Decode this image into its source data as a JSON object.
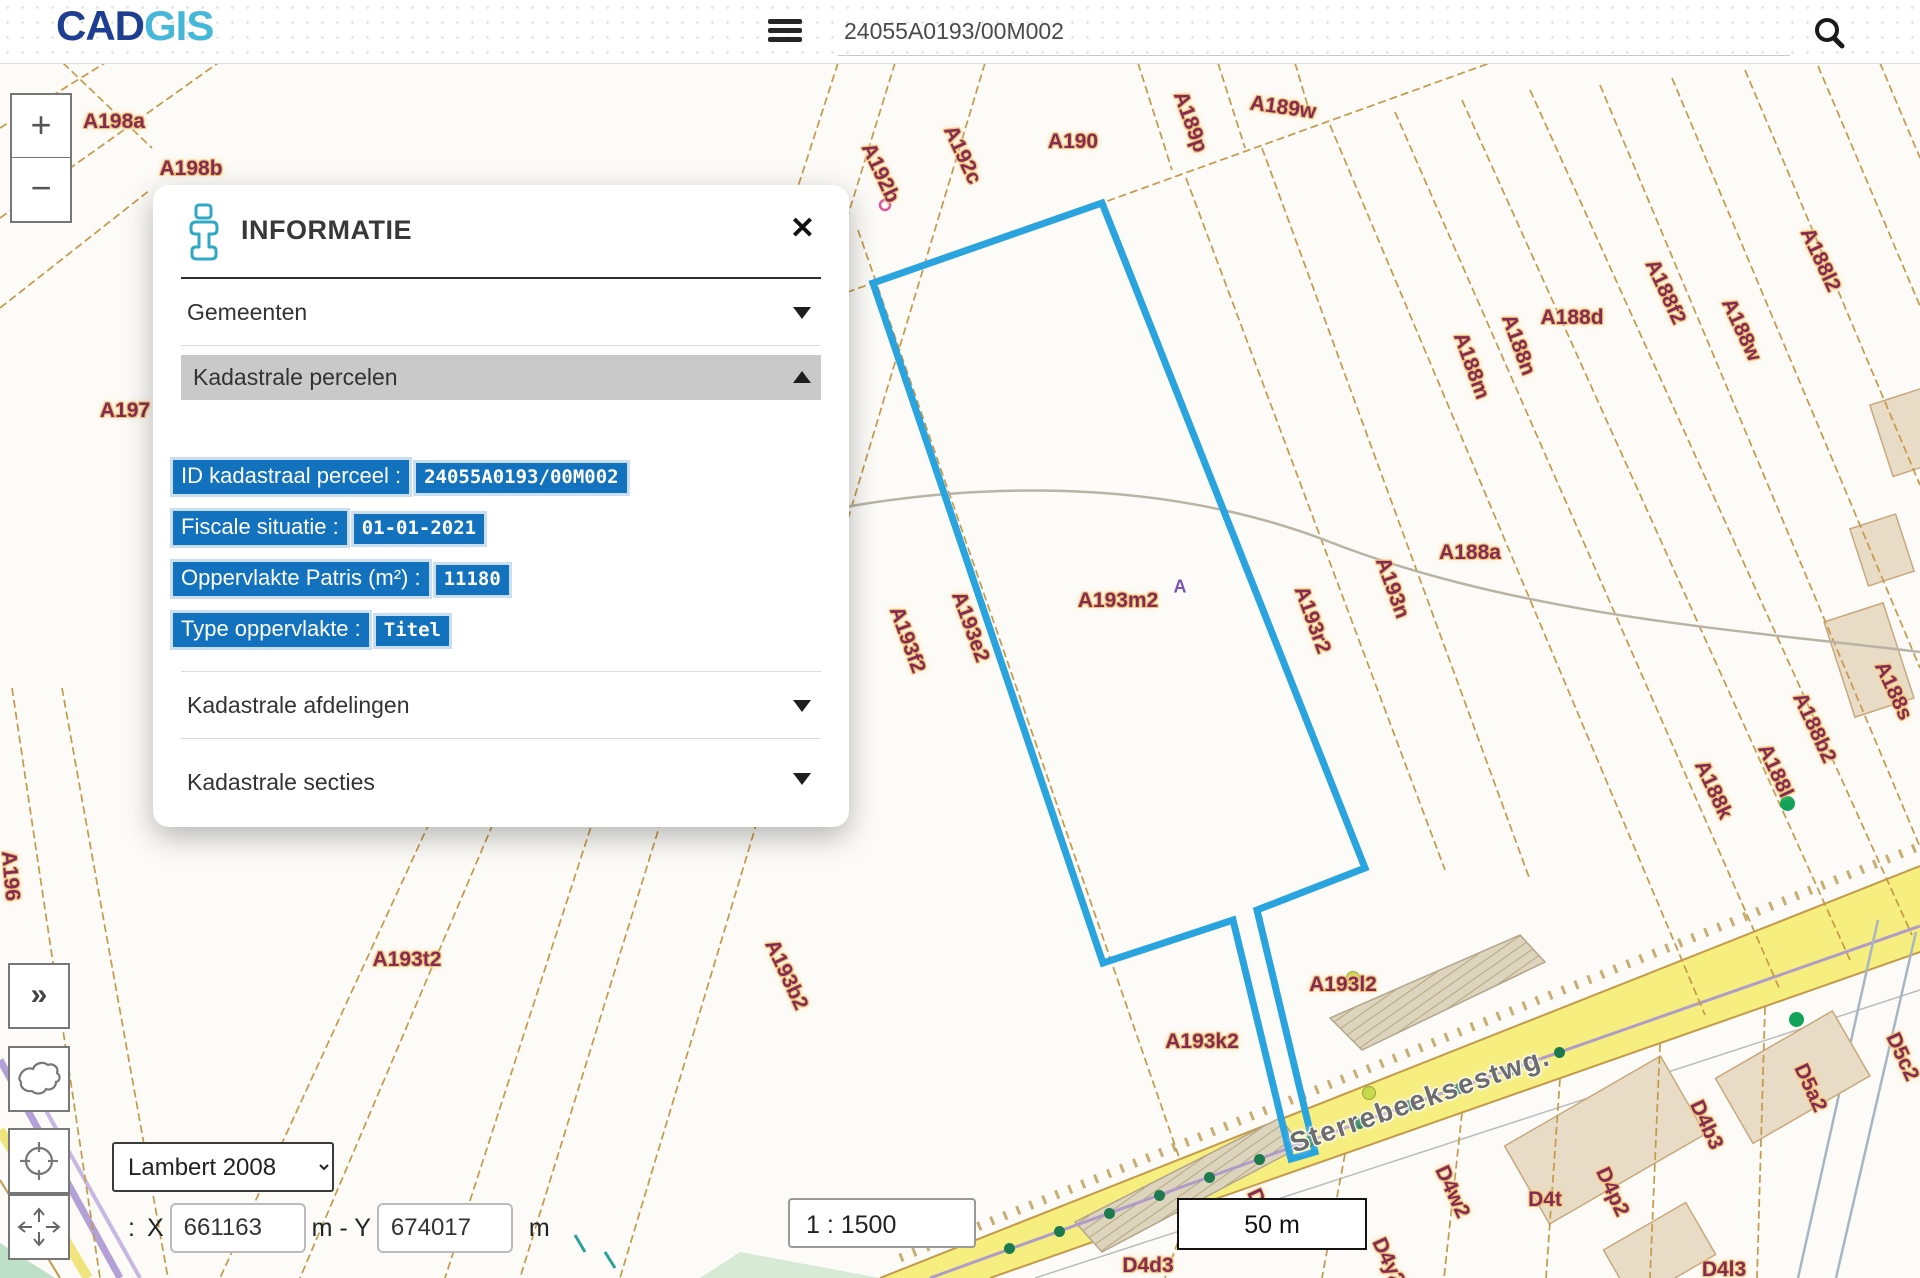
{
  "header": {
    "logo_primary": "CAD",
    "logo_secondary": "GIS",
    "search_value": "24055A0193/00M002"
  },
  "panel": {
    "title": "INFORMATIE",
    "close_label": "✕",
    "sections": {
      "gemeenten": "Gemeenten",
      "percelen": "Kadastrale percelen",
      "afdelingen": "Kadastrale afdelingen",
      "secties": "Kadastrale secties"
    },
    "fields": [
      {
        "label": "ID kadastraal perceel :",
        "value": "24055A0193/00M002"
      },
      {
        "label": "Fiscale situatie :",
        "value": "01-01-2021"
      },
      {
        "label": "Oppervlakte Patris (m²) :",
        "value": "11180"
      },
      {
        "label": "Type oppervlakte :",
        "value": "Titel"
      }
    ]
  },
  "controls": {
    "zoom_in": "+",
    "zoom_out": "−",
    "expand": "»",
    "projection": "Lambert 2008",
    "coord_prefix": ":",
    "x_label": "X",
    "x_value": "661163",
    "y_sep": "m - Y",
    "y_value": "674017",
    "unit": "m",
    "scale": "1 : 1500",
    "scalebar": "50 m"
  },
  "map": {
    "selected_parcel": "24055A0193/00M002",
    "colors": {
      "parcel_line": "#c49a4a",
      "label": "#822b55",
      "label_halo": "#f2c173",
      "selection": "#29a4de",
      "road_fill": "#f6ee7f",
      "building": "#e9dcc6",
      "highlight_chip": "#1372bd"
    },
    "labels": [
      {
        "t": "A198a",
        "x": 114,
        "y": 59,
        "r": 0
      },
      {
        "t": "A198b",
        "x": 191,
        "y": 106,
        "r": 0
      },
      {
        "t": "A197",
        "x": 125,
        "y": 348,
        "r": 0
      },
      {
        "t": "A196",
        "x": 10,
        "y": 813,
        "r": 85
      },
      {
        "t": "A193t2",
        "x": 407,
        "y": 897,
        "r": 0
      },
      {
        "t": "A193b2",
        "x": 786,
        "y": 912,
        "r": 65
      },
      {
        "t": "A192b",
        "x": 880,
        "y": 110,
        "r": 65
      },
      {
        "t": "A192c",
        "x": 962,
        "y": 92,
        "r": 65
      },
      {
        "t": "A190",
        "x": 1073,
        "y": 79,
        "r": 0
      },
      {
        "t": "A189p",
        "x": 1190,
        "y": 59,
        "r": 70
      },
      {
        "t": "A189w",
        "x": 1283,
        "y": 45,
        "r": 8
      },
      {
        "t": "A188d",
        "x": 1572,
        "y": 255,
        "r": 0
      },
      {
        "t": "A188f2",
        "x": 1665,
        "y": 229,
        "r": 65
      },
      {
        "t": "A188w",
        "x": 1741,
        "y": 267,
        "r": 65
      },
      {
        "t": "A188l2",
        "x": 1820,
        "y": 197,
        "r": 65
      },
      {
        "t": "A188m",
        "x": 1471,
        "y": 303,
        "r": 70
      },
      {
        "t": "A188n",
        "x": 1518,
        "y": 282,
        "r": 70
      },
      {
        "t": "A188a",
        "x": 1470,
        "y": 490,
        "r": 0
      },
      {
        "t": "A193n",
        "x": 1392,
        "y": 525,
        "r": 70
      },
      {
        "t": "A193r2",
        "x": 1312,
        "y": 557,
        "r": 70
      },
      {
        "t": "A193f2",
        "x": 907,
        "y": 577,
        "r": 70
      },
      {
        "t": "A193e2",
        "x": 970,
        "y": 564,
        "r": 70
      },
      {
        "t": "A193m2",
        "x": 1118,
        "y": 538,
        "r": 0
      },
      {
        "t": "A",
        "x": 1180,
        "y": 524,
        "r": 0,
        "c": "sup"
      },
      {
        "t": "A193l2",
        "x": 1343,
        "y": 922,
        "r": 0
      },
      {
        "t": "A193k2",
        "x": 1202,
        "y": 979,
        "r": 0
      },
      {
        "t": "A188k",
        "x": 1713,
        "y": 727,
        "r": 65
      },
      {
        "t": "A188l",
        "x": 1775,
        "y": 708,
        "r": 65
      },
      {
        "t": "A188b2",
        "x": 1814,
        "y": 665,
        "r": 65
      },
      {
        "t": "A188s",
        "x": 1893,
        "y": 628,
        "r": 65
      },
      {
        "t": "D5c2",
        "x": 1902,
        "y": 994,
        "r": 65
      },
      {
        "t": "D5a2",
        "x": 1810,
        "y": 1025,
        "r": 65
      },
      {
        "t": "D4b3",
        "x": 1706,
        "y": 1062,
        "r": 65
      },
      {
        "t": "D4p2",
        "x": 1612,
        "y": 1129,
        "r": 65
      },
      {
        "t": "D4w2",
        "x": 1452,
        "y": 1129,
        "r": 65
      },
      {
        "t": "D4t",
        "x": 1545,
        "y": 1137,
        "r": 0
      },
      {
        "t": "D4x2",
        "x": 1263,
        "y": 1150,
        "r": 65
      },
      {
        "t": "D4y2",
        "x": 1388,
        "y": 1199,
        "r": 65
      },
      {
        "t": "D4l3",
        "x": 1724,
        "y": 1207,
        "r": 0
      },
      {
        "t": "D4d3",
        "x": 1148,
        "y": 1203,
        "r": 0
      },
      {
        "t": "Sterrebeeksestwg.",
        "x": 1420,
        "y": 1037,
        "r": -19,
        "c": "road"
      }
    ],
    "tree_dots": [
      [
        1010,
        1186
      ],
      [
        1060,
        1169
      ],
      [
        1110,
        1151
      ],
      [
        1160,
        1133
      ],
      [
        1210,
        1115
      ],
      [
        1260,
        1097
      ],
      [
        1310,
        1079
      ],
      [
        1360,
        1061
      ],
      [
        1410,
        1043
      ],
      [
        1460,
        1026
      ],
      [
        1510,
        1008
      ],
      [
        1560,
        990
      ]
    ],
    "green_markers": [
      [
        1786,
        739
      ],
      [
        1795,
        955
      ]
    ],
    "lime_markers": [
      [
        1368,
        1029
      ],
      [
        1352,
        914
      ]
    ]
  }
}
